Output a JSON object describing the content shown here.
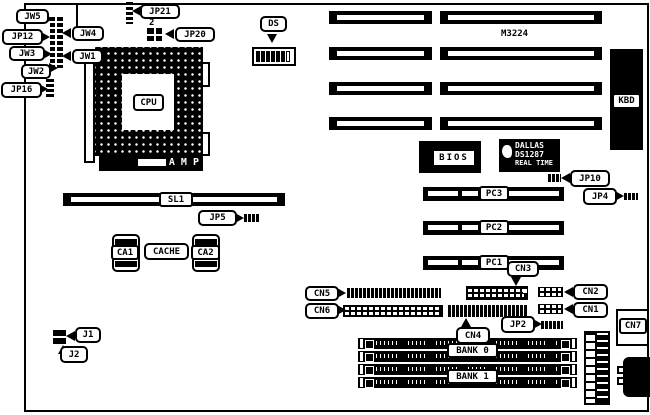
{
  "board": {
    "model": "M3224",
    "background": "#ffffff",
    "ink": "#000000"
  },
  "labels": {
    "jw5": "JW5",
    "jw4": "JW4",
    "jp12": "JP12",
    "jw3": "JW3",
    "jw1": "JW1",
    "jw2": "JW2",
    "jp16": "JP16",
    "jp21": "JP21",
    "jp21_pin2": "2",
    "jp20": "JP20",
    "ds": "DS",
    "cpu": "CPU",
    "amp": "A M P",
    "m3224": "M3224",
    "kbd": "KBD",
    "bios": "BIOS",
    "dallas_line1": "DALLAS",
    "dallas_line2": "DS1287",
    "dallas_line3": "REAL TIME",
    "jp10": "JP10",
    "jp4": "JP4",
    "sl1": "SL1",
    "jp5": "JP5",
    "ca1": "CA1",
    "cache": "CACHE",
    "ca2": "CA2",
    "pc3": "PC3",
    "pc2": "PC2",
    "pc1": "PC1",
    "cn5": "CN5",
    "cn6": "CN6",
    "cn3": "CN3",
    "cn4": "CN4",
    "cn2": "CN2",
    "cn1": "CN1",
    "cn7": "CN7",
    "jp2": "JP2",
    "j1": "J1",
    "j2": "J2",
    "bank0": "BANK 0",
    "bank1": "BANK 1"
  }
}
